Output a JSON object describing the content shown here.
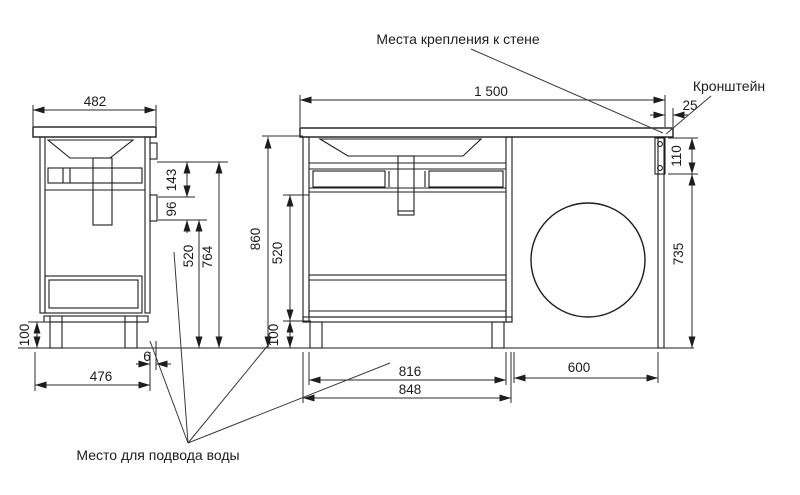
{
  "drawing": {
    "labels": {
      "wall_mount": "Места крепления к стене",
      "bracket": "Кронштейн",
      "water_supply": "Место для подвода воды"
    },
    "side": {
      "top_width": "482",
      "basin_to_cutout": "143",
      "cutout_height": "96",
      "cutout_to_floor": "520",
      "worktop_to_floor": "764",
      "leg_height": "100",
      "bottom_width": "476",
      "back_gap": "6"
    },
    "front": {
      "total_width": "1 500",
      "edge_offset": "25",
      "bracket_height": "110",
      "bracket_to_floor": "735",
      "total_height": "860",
      "drawer_to_plinth": "520",
      "leg_height": "100",
      "opening_width": "816",
      "cabinet_width": "848",
      "machine_space": "600"
    }
  }
}
